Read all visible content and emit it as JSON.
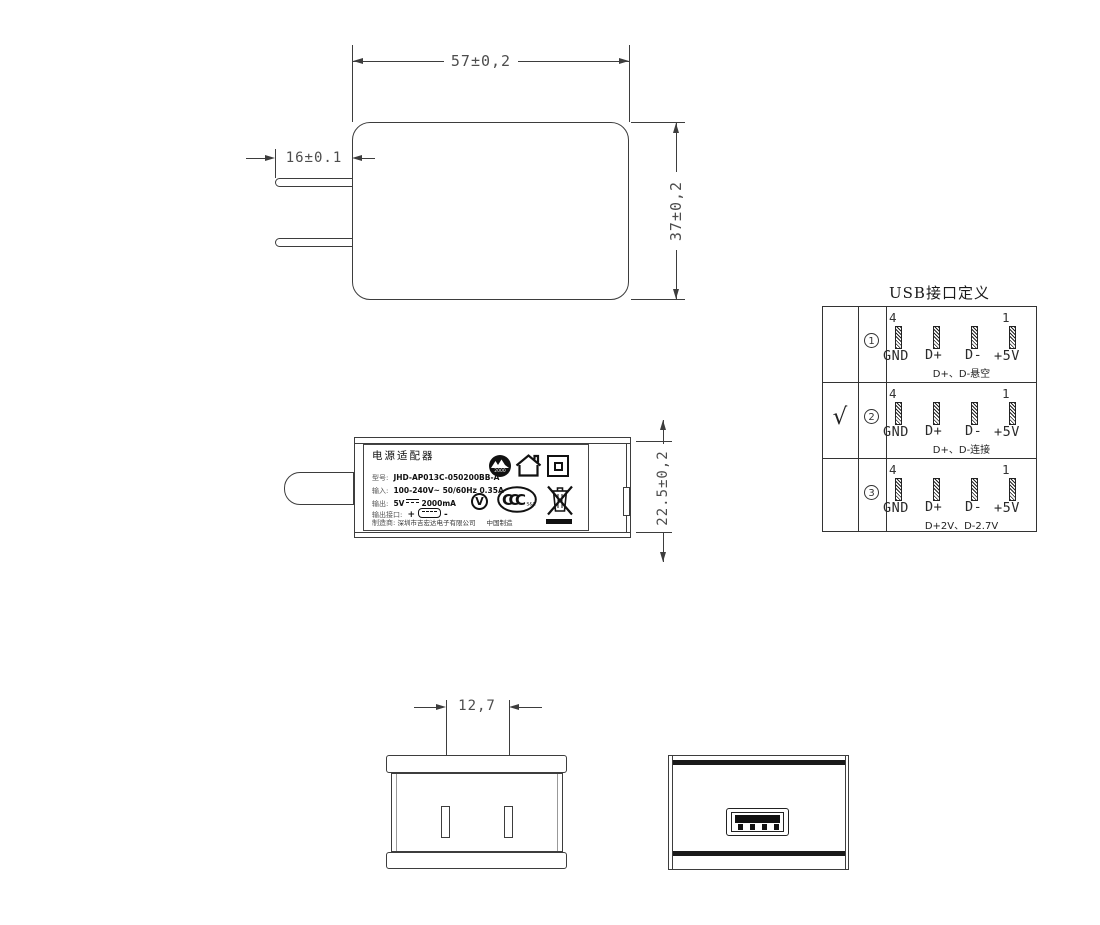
{
  "front_view": {
    "width_dim": "57±0,2",
    "height_dim": "37±0,2",
    "prong_length_dim": "16±0.1"
  },
  "side_view": {
    "height_dim": "22.5±0,2",
    "label": {
      "title": "电源适配器",
      "model_key": "型号:",
      "model_value": "JHD-AP013C-050200BB-A",
      "input_key": "输入:",
      "input_value": "100-240V~  50/60Hz  0.35A",
      "output_key": "输出:",
      "output_voltage": "5V",
      "output_current": "2000mA",
      "port_key": "输出接口:",
      "port_plus": "+",
      "port_minus": "-",
      "maker_key": "制造商:",
      "maker_value": "深圳市吉宏达电子有限公司",
      "origin": "中国制造",
      "marks": {
        "logo_text": "2000",
        "efficiency_level": "V",
        "ccc": "CCC",
        "ccc_sub": "S&E"
      }
    }
  },
  "bottom_view": {
    "pin_pitch_dim": "12,7"
  },
  "usb_table": {
    "title": "USB接口定义",
    "pin_number_left": "4",
    "pin_number_right": "1",
    "pin_labels": [
      "GND",
      "D+",
      "D-",
      "+5V"
    ],
    "rows": [
      {
        "check": "",
        "num": "1",
        "note": "D+、D-悬空"
      },
      {
        "check": "√",
        "num": "2",
        "note": "D+、D-连接"
      },
      {
        "check": "",
        "num": "3",
        "note": "D+2V、D-2.7V"
      }
    ]
  }
}
